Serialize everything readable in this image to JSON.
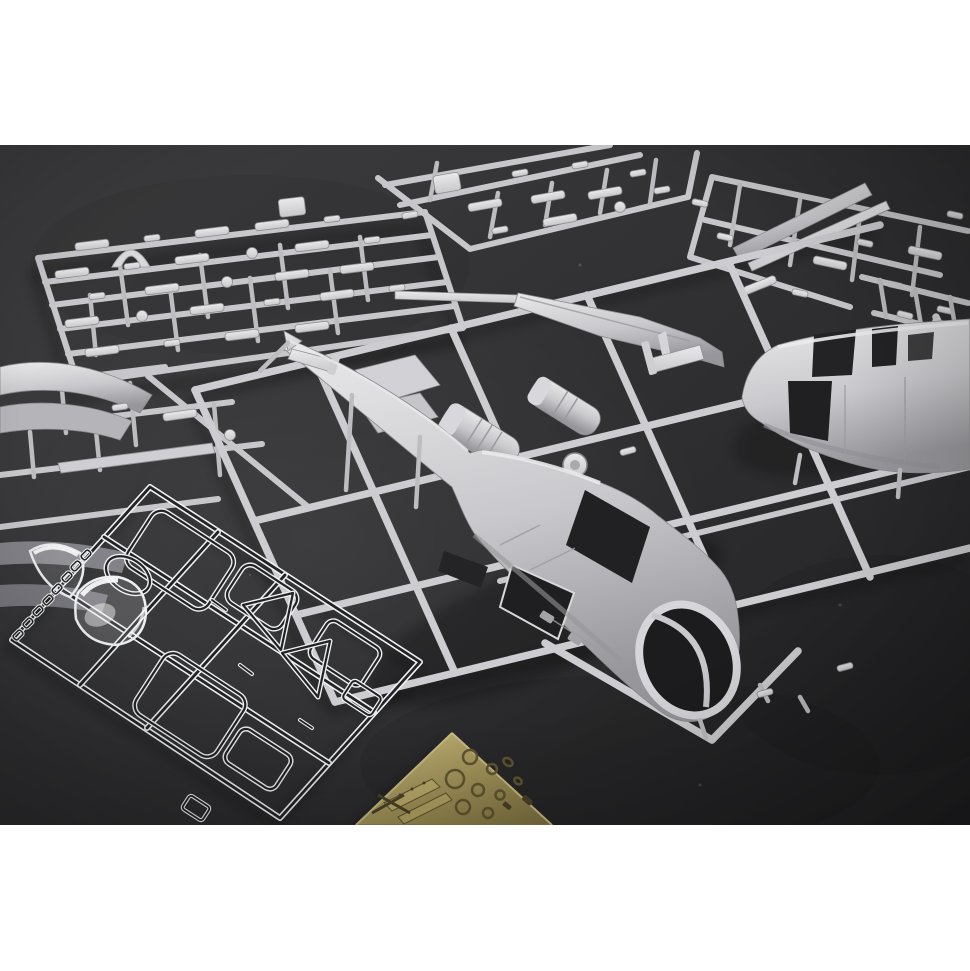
{
  "page": {
    "background": "#ffffff",
    "top_band": "white margin above photo",
    "bottom_band": "white margin below photo"
  },
  "photo": {
    "subject": "Unassembled helicopter scale-model kit sprues photographed on a dark grey surface",
    "colors": {
      "backdrop_light": "#3d3d3f",
      "backdrop_dark": "#222224",
      "plastic_highlight": "#e9e9eb",
      "plastic_mid": "#c9c9cd",
      "plastic_shadow": "#97979b",
      "clear_edge": "#edeff2",
      "brass_light": "#c6b87d",
      "brass_mid": "#a3945a",
      "brass_dark": "#7b6e3e"
    },
    "objects": [
      {
        "id": "sprue-small-parts-top-left",
        "material": "grey styrene",
        "contents": "rows of small airframe detail parts and a curved dome piece"
      },
      {
        "id": "sprue-detail-top-center",
        "material": "grey styrene",
        "contents": "small detail parts, cropped by top edge of photo"
      },
      {
        "id": "sprue-rotor-top-right",
        "material": "grey styrene",
        "contents": "long rotor blade, thin strip and small parts, cropped at right"
      },
      {
        "id": "sprue-main-center",
        "material": "grey styrene",
        "contents": "large runner frame with two helicopter fuselage halves, tail boom with fin, engine cylinders, seats and a rotor disc"
      },
      {
        "id": "sprue-partial-left",
        "material": "grey styrene",
        "contents": "engine cowling panels, skid bar and dark underside parts, cropped at left edge"
      },
      {
        "id": "sprue-clear-bottom-left",
        "material": "clear styrene",
        "contents": "bubble canopy, curved windscreen, ring, cabin window panes, triangular quarter-lights and a row of tiny glazing parts"
      },
      {
        "id": "photo-etch-fret",
        "material": "brass photo-etch",
        "contents": "etched rings, dials, instrument-panel strips and cross-hatched details"
      }
    ]
  }
}
